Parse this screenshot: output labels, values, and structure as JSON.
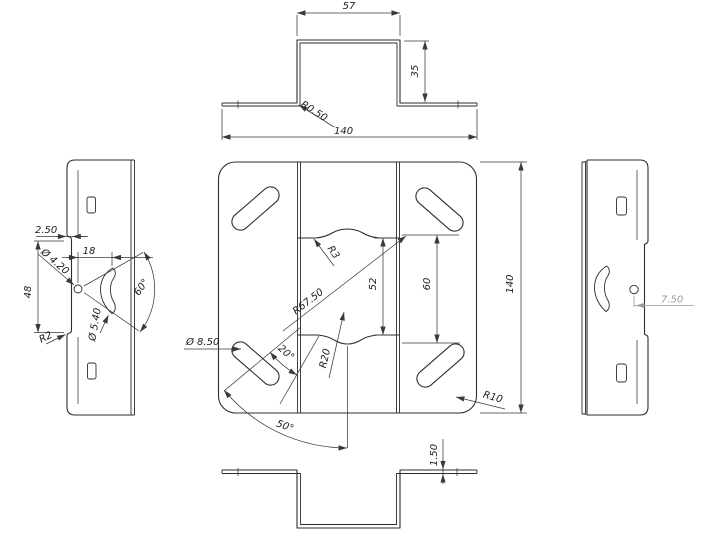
{
  "drawing_type": "sheet-metal bracket multi-view CAD drawing",
  "colors": {
    "background": "#ffffff",
    "outline": "#2d2d2d",
    "dimension": "#3a3a3a",
    "dimension_muted": "#9b9b9b"
  },
  "views": {
    "top": {
      "name": "top profile view (hat section)",
      "dims": {
        "w": "57",
        "h": "35",
        "r": "R0.50",
        "total": "140"
      }
    },
    "plan": {
      "name": "front plan view",
      "dims": {
        "r3": "R3",
        "h52": "52",
        "h60": "60",
        "r675": "R67.50",
        "dia85": "Ø 8.50",
        "a20": "20°",
        "r20": "R20",
        "a50": "50°",
        "h140": "140",
        "r10": "R10"
      }
    },
    "left": {
      "name": "left side view",
      "dims": {
        "step": "2.50",
        "dia42": "Ø 4.20",
        "w18": "18",
        "h48": "48",
        "dia54": "Ø 5.40",
        "a60": "60°",
        "r2": "R2"
      }
    },
    "right": {
      "name": "right side view",
      "dims": {
        "off75": "7.50"
      }
    },
    "bottom": {
      "name": "bottom profile view (inverted hat)",
      "dims": {
        "t15": "1.50"
      }
    }
  }
}
